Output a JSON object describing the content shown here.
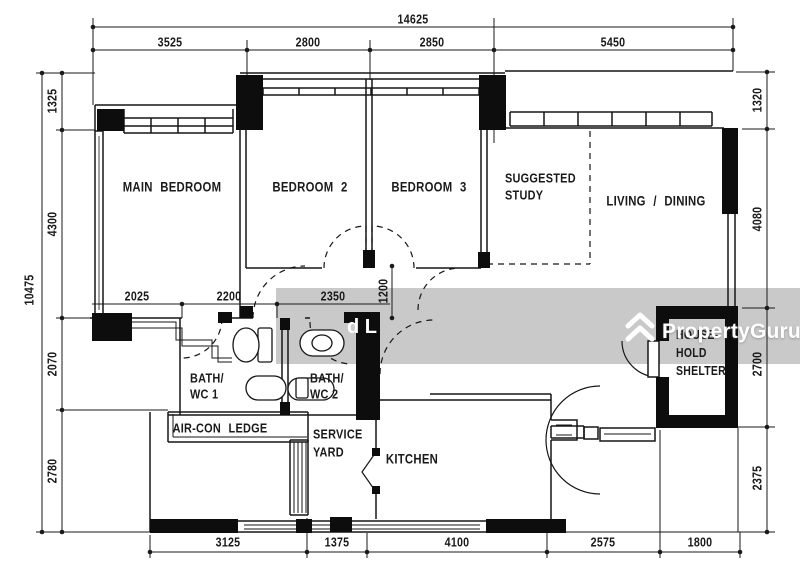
{
  "watermark": {
    "brand": "PropertyGuru",
    "partial_text": "d L"
  },
  "colors": {
    "background": "#ffffff",
    "line": "#1a1a1a",
    "wall_fill": "#0d0d0d",
    "watermark_band": "#c9c9c9",
    "watermark_text": "#ffffff"
  },
  "rooms": {
    "main_bedroom": "MAIN BEDROOM",
    "bedroom_2": "BEDROOM 2",
    "bedroom_3": "BEDROOM 3",
    "suggested_study_1": "SUGGESTED",
    "suggested_study_2": "STUDY",
    "living_dining": "LIVING / DINING",
    "bath_wc_1_1": "BATH/",
    "bath_wc_1_2": "WC 1",
    "bath_wc_2_1": "BATH/",
    "bath_wc_2_2": "WC 2",
    "aircon_ledge": "AIR-CON LEDGE",
    "service_yard_1": "SERVICE",
    "service_yard_2": "YARD",
    "kitchen": "KITCHEN",
    "household_shelter_1": "HOUSE-",
    "household_shelter_2": "HOLD",
    "household_shelter_3": "SHELTER"
  },
  "dims": {
    "top_overall": "14625",
    "top_1": "3525",
    "top_2": "2800",
    "top_3": "2850",
    "top_4": "5450",
    "left_overall": "10475",
    "left_1": "1325",
    "left_2": "4300",
    "left_3": "2070",
    "left_4": "2780",
    "right_1": "1320",
    "right_2": "4080",
    "right_3": "2700",
    "right_4": "2375",
    "bottom_1": "3125",
    "bottom_2": "1375",
    "bottom_3": "4100",
    "bottom_4": "2575",
    "bottom_5": "1800",
    "inner_1": "2025",
    "inner_2": "2200",
    "inner_3": "2350",
    "inner_4": "1200"
  }
}
